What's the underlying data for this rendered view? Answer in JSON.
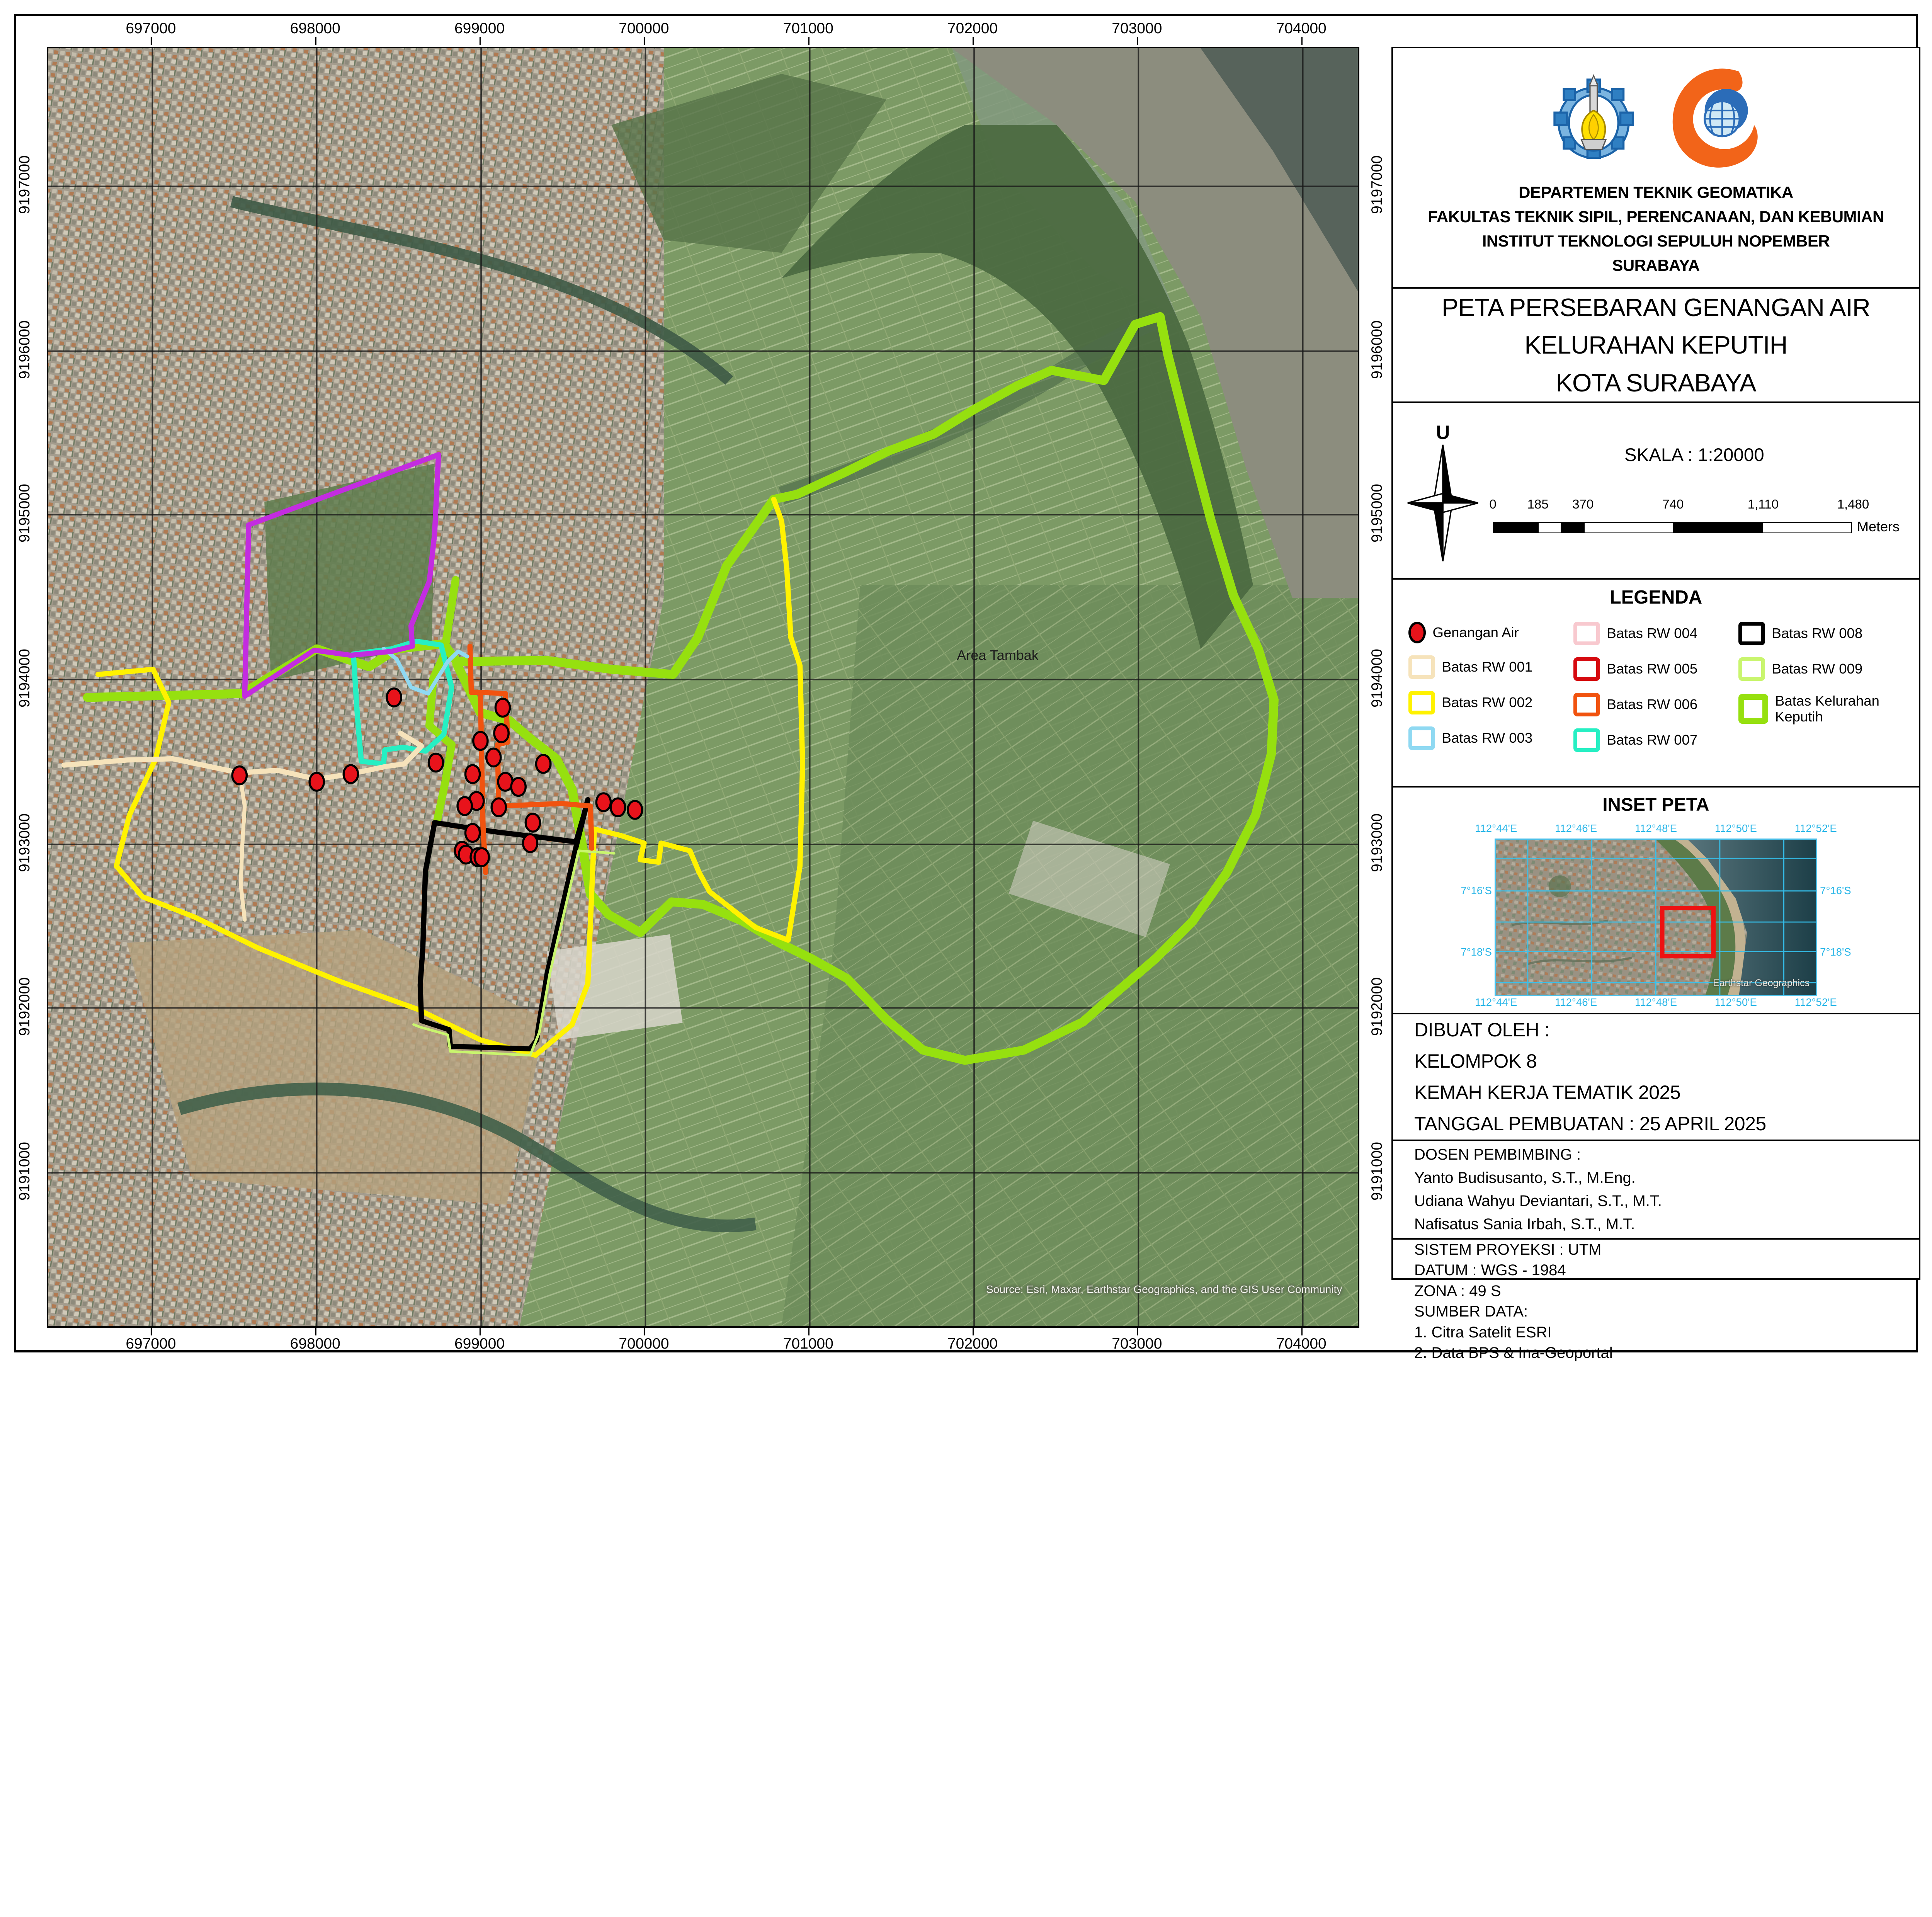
{
  "map": {
    "x_ticks": [
      {
        "label": "697000",
        "pos": 7.95
      },
      {
        "label": "698000",
        "pos": 20.5
      },
      {
        "label": "699000",
        "pos": 33.05
      },
      {
        "label": "700000",
        "pos": 45.6
      },
      {
        "label": "701000",
        "pos": 58.15
      },
      {
        "label": "702000",
        "pos": 70.7
      },
      {
        "label": "703000",
        "pos": 83.25
      },
      {
        "label": "704000",
        "pos": 95.8
      }
    ],
    "y_ticks": [
      {
        "label": "9197000",
        "pos": 10.8
      },
      {
        "label": "9196000",
        "pos": 23.7
      },
      {
        "label": "9195000",
        "pos": 36.5
      },
      {
        "label": "9194000",
        "pos": 49.4
      },
      {
        "label": "9193000",
        "pos": 62.3
      },
      {
        "label": "9192000",
        "pos": 75.1
      },
      {
        "label": "9191000",
        "pos": 88.0
      }
    ],
    "area_label": "Area Tambak",
    "attribution": "Source: Esri, Maxar, Earthstar Geographics, and the GIS User Community",
    "point_style": {
      "fill": "#e8131b",
      "stroke": "#000000"
    },
    "genangan_points": [
      [
        347,
        516
      ],
      [
        346,
        536
      ],
      [
        330,
        542
      ],
      [
        340,
        555
      ],
      [
        378,
        560
      ],
      [
        296,
        559
      ],
      [
        324,
        568
      ],
      [
        349,
        574
      ],
      [
        359,
        578
      ],
      [
        327,
        589
      ],
      [
        318,
        593
      ],
      [
        344,
        594
      ],
      [
        424,
        590
      ],
      [
        435,
        594
      ],
      [
        448,
        596
      ],
      [
        370,
        606
      ],
      [
        324,
        614
      ],
      [
        368,
        622
      ],
      [
        316,
        628
      ],
      [
        319,
        631
      ],
      [
        328,
        633
      ],
      [
        331,
        633
      ],
      [
        264,
        508
      ],
      [
        146,
        569
      ],
      [
        205,
        574
      ],
      [
        231,
        568
      ]
    ],
    "boundaries": [
      {
        "name": "Batas Kelurahan Keputih",
        "color": "#96e00f",
        "width": 7,
        "points": [
          [
            30,
            508
          ],
          [
            148,
            505
          ],
          [
            205,
            470
          ],
          [
            245,
            484
          ],
          [
            266,
            470
          ],
          [
            302,
            466
          ],
          [
            312,
            480
          ],
          [
            380,
            479
          ],
          [
            430,
            486
          ],
          [
            477,
            490
          ],
          [
            496,
            461
          ],
          [
            518,
            405
          ],
          [
            554,
            353
          ],
          [
            572,
            349
          ],
          [
            608,
            332
          ],
          [
            642,
            315
          ],
          [
            676,
            302
          ],
          [
            708,
            282
          ],
          [
            740,
            264
          ],
          [
            766,
            252
          ],
          [
            806,
            260
          ],
          [
            830,
            216
          ],
          [
            849,
            210
          ],
          [
            855,
            240
          ],
          [
            870,
            300
          ],
          [
            888,
            370
          ],
          [
            905,
            428
          ],
          [
            924,
            470
          ],
          [
            936,
            510
          ],
          [
            934,
            552
          ],
          [
            922,
            600
          ],
          [
            900,
            645
          ],
          [
            874,
            683
          ],
          [
            846,
            712
          ],
          [
            812,
            742
          ],
          [
            790,
            762
          ],
          [
            745,
            784
          ],
          [
            700,
            792
          ],
          [
            668,
            784
          ],
          [
            640,
            760
          ],
          [
            610,
            728
          ],
          [
            582,
            712
          ],
          [
            558,
            700
          ],
          [
            530,
            683
          ],
          [
            500,
            670
          ],
          [
            476,
            668
          ],
          [
            452,
            692
          ],
          [
            428,
            678
          ],
          [
            414,
            662
          ],
          [
            408,
            625
          ],
          [
            400,
            580
          ],
          [
            388,
            556
          ],
          [
            368,
            540
          ],
          [
            352,
            526
          ],
          [
            330,
            520
          ],
          [
            312,
            482
          ]
        ]
      },
      {
        "name": "Batas Kelurahan Keputih segmen barat",
        "color": "#96e00f",
        "width": 6,
        "points": [
          [
            311,
            416
          ],
          [
            302,
            475
          ],
          [
            294,
            493
          ],
          [
            291,
            530
          ],
          [
            300,
            538
          ],
          [
            308,
            545
          ],
          [
            303,
            575
          ],
          [
            297,
            604
          ]
        ]
      },
      {
        "name": "Batas RW 002",
        "color": "#fff200",
        "width": 4,
        "points": [
          [
            38,
            490
          ],
          [
            80,
            486
          ],
          [
            92,
            512
          ],
          [
            82,
            556
          ],
          [
            62,
            600
          ],
          [
            52,
            640
          ],
          [
            72,
            664
          ],
          [
            112,
            680
          ],
          [
            160,
            704
          ],
          [
            222,
            730
          ],
          [
            282,
            752
          ],
          [
            330,
            776
          ],
          [
            372,
            788
          ],
          [
            400,
            764
          ],
          [
            412,
            732
          ],
          [
            417,
            611
          ],
          [
            437,
            616
          ],
          [
            455,
            622
          ],
          [
            452,
            635
          ],
          [
            466,
            637
          ],
          [
            468,
            622
          ],
          [
            490,
            628
          ],
          [
            497,
            645
          ],
          [
            505,
            660
          ],
          [
            540,
            688
          ],
          [
            565,
            698
          ],
          [
            574,
            640
          ],
          [
            576,
            560
          ],
          [
            574,
            483
          ],
          [
            567,
            461
          ],
          [
            564,
            408
          ],
          [
            560,
            370
          ],
          [
            554,
            353
          ]
        ]
      },
      {
        "name": "Batas RW 008",
        "color": "#000000",
        "width": 4,
        "points": [
          [
            412,
            588
          ],
          [
            403,
            625
          ],
          [
            381,
            724
          ],
          [
            374,
            768
          ],
          [
            373,
            776
          ],
          [
            368,
            783
          ],
          [
            307,
            781
          ],
          [
            306,
            768
          ],
          [
            285,
            761
          ],
          [
            284,
            733
          ],
          [
            286,
            704
          ],
          [
            288,
            644
          ],
          [
            295,
            606
          ],
          [
            340,
            613
          ],
          [
            380,
            618
          ],
          [
            403,
            621
          ],
          [
            409,
            600
          ],
          [
            412,
            588
          ]
        ]
      },
      {
        "name": "Batas RW 009",
        "color": "#c9f56e",
        "width": 2,
        "points": [
          [
            279,
            764
          ],
          [
            284,
            766
          ],
          [
            305,
            772
          ],
          [
            307,
            785
          ],
          [
            368,
            788
          ],
          [
            375,
            770
          ],
          [
            383,
            724
          ],
          [
            405,
            628
          ],
          [
            432,
            630
          ]
        ]
      },
      {
        "name": "Batas RW 006",
        "color": "#f1530f",
        "width": 4,
        "points": [
          [
            322,
            468
          ],
          [
            323,
            504
          ],
          [
            330,
            504
          ],
          [
            349,
            505
          ],
          [
            351,
            543
          ],
          [
            343,
            545
          ],
          [
            344,
            593
          ],
          [
            392,
            591
          ],
          [
            414,
            593
          ],
          [
            415,
            626
          ]
        ]
      },
      {
        "name": "Batas RW 006 segmen barat",
        "color": "#f1530f",
        "width": 4,
        "points": [
          [
            330,
            506
          ],
          [
            331,
            560
          ],
          [
            332,
            610
          ],
          [
            334,
            645
          ]
        ]
      },
      {
        "name": "Batas RW 007",
        "color": "#26efc3",
        "width": 4,
        "points": [
          [
            233,
            474
          ],
          [
            262,
            470
          ],
          [
            281,
            464
          ],
          [
            300,
            467
          ],
          [
            308,
            500
          ],
          [
            302,
            537
          ],
          [
            288,
            550
          ],
          [
            271,
            547
          ],
          [
            257,
            549
          ],
          [
            256,
            560
          ],
          [
            239,
            558
          ],
          [
            236,
            522
          ],
          [
            233,
            474
          ]
        ]
      },
      {
        "name": "Batas RW 003",
        "color": "#8fd9f2",
        "width": 3,
        "points": [
          [
            256,
            470
          ],
          [
            266,
            478
          ],
          [
            277,
            500
          ],
          [
            290,
            505
          ],
          [
            305,
            480
          ],
          [
            313,
            472
          ],
          [
            320,
            476
          ]
        ]
      },
      {
        "name": "Batas RW 004-005 ungu",
        "color": "#c32ce0",
        "width": 4,
        "points": [
          [
            153,
            373
          ],
          [
            298,
            318
          ],
          [
            295,
            380
          ],
          [
            291,
            417
          ],
          [
            277,
            452
          ],
          [
            278,
            468
          ],
          [
            262,
            472
          ],
          [
            231,
            475
          ],
          [
            203,
            471
          ],
          [
            150,
            507
          ],
          [
            153,
            373
          ]
        ]
      },
      {
        "name": "Batas RW 001",
        "color": "#f6e3bb",
        "width": 4,
        "points": [
          [
            12,
            561
          ],
          [
            60,
            557
          ],
          [
            95,
            556
          ],
          [
            146,
            567
          ],
          [
            175,
            565
          ],
          [
            205,
            572
          ],
          [
            230,
            568
          ],
          [
            258,
            562
          ],
          [
            272,
            560
          ],
          [
            285,
            546
          ],
          [
            269,
            536
          ]
        ]
      },
      {
        "name": "Batas RW 001 segmen selatan",
        "color": "#f6e3bb",
        "width": 3,
        "points": [
          [
            146,
            567
          ],
          [
            150,
            593
          ],
          [
            148,
            626
          ],
          [
            147,
            655
          ],
          [
            150,
            682
          ]
        ]
      }
    ]
  },
  "panel": {
    "header": {
      "institution_lines": [
        "DEPARTEMEN TEKNIK GEOMATIKA",
        "FAKULTAS TEKNIK SIPIL, PERENCANAAN, DAN KEBUMIAN",
        "INSTITUT TEKNOLOGI SEPULUH NOPEMBER",
        "SURABAYA"
      ]
    },
    "title": {
      "lines": [
        "PETA PERSEBARAN GENANGAN AIR",
        "KELURAHAN KEPUTIH",
        "KOTA SURABAYA"
      ]
    },
    "scale": {
      "skala_label": "SKALA : 1:20000",
      "north_label": "U",
      "bar_labels": [
        "0",
        "185",
        "370",
        "740",
        "1,110",
        "1,480"
      ],
      "unit_label": "Meters"
    },
    "legend": {
      "title": "LEGENDA",
      "items": [
        {
          "label": "Genangan Air",
          "type": "point",
          "color": "#e8131b"
        },
        {
          "label": "Batas RW 001",
          "type": "line",
          "color": "#f6e3bb"
        },
        {
          "label": "Batas RW 002",
          "type": "line",
          "color": "#fff200"
        },
        {
          "label": "Batas RW 003",
          "type": "line",
          "color": "#8fd9f2"
        },
        {
          "label": "Batas RW 004",
          "type": "line",
          "color": "#f8c9cf"
        },
        {
          "label": "Batas RW 005",
          "type": "line",
          "color": "#d60a10"
        },
        {
          "label": "Batas RW 006",
          "type": "line",
          "color": "#f1530f"
        },
        {
          "label": "Batas RW 007",
          "type": "line",
          "color": "#26efc3"
        },
        {
          "label": "Batas RW 008",
          "type": "line",
          "color": "#000000"
        },
        {
          "label": "Batas RW 009",
          "type": "line",
          "color": "#c9f56e"
        },
        {
          "label": "Batas Kelurahan Keputih",
          "type": "line-thick",
          "color": "#96e00f"
        }
      ]
    },
    "inset": {
      "title": "INSET PETA",
      "lon_labels": [
        "112°44'E",
        "112°46'E",
        "112°48'E",
        "112°50'E",
        "112°52'E"
      ],
      "lat_labels": [
        "7°16'S",
        "7°18'S"
      ],
      "watermark": "Earthstar Geographics",
      "grid_color": "#35c3f0",
      "extent_color": "#ee1111"
    },
    "made_by": {
      "lines": [
        "DIBUAT OLEH :",
        "KELOMPOK 8",
        "KEMAH KERJA TEMATIK 2025",
        "TANGGAL PEMBUATAN : 25 APRIL 2025"
      ]
    },
    "supervisors": {
      "lines": [
        "DOSEN PEMBIMBING :",
        "Yanto Budisusanto, S.T., M.Eng.",
        "Udiana Wahyu Deviantari, S.T., M.T.",
        "Nafisatus Sania Irbah, S.T., M.T."
      ]
    },
    "projection": {
      "lines": [
        "SISTEM PROYEKSI : UTM",
        "DATUM : WGS - 1984",
        "ZONA : 49 S",
        "SUMBER DATA:",
        "1. Citra Satelit ESRI",
        "2. Data BPS & Ina-Geoportal",
        "3. Geotagging Genangan Air"
      ]
    }
  }
}
